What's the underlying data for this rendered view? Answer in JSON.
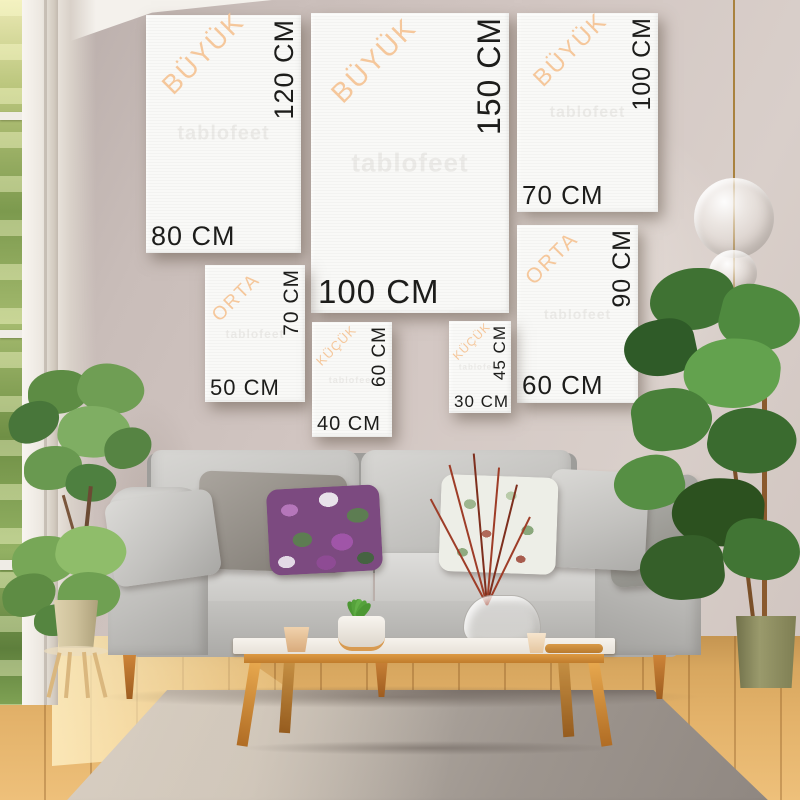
{
  "watermark_text": "tablofeet",
  "size_guide": {
    "unit": "CM",
    "size_names": {
      "large": "BÜYÜK",
      "medium": "ORTA",
      "small": "KÜÇÜK"
    },
    "canvases": [
      {
        "category": "BÜYÜK",
        "width": "80 CM",
        "height": "120 CM"
      },
      {
        "category": "BÜYÜK",
        "width": "100 CM",
        "height": "150 CM"
      },
      {
        "category": "BÜYÜK",
        "width": "70 CM",
        "height": "100 CM"
      },
      {
        "category": "ORTA",
        "width": "60 CM",
        "height": "90 CM"
      },
      {
        "category": "ORTA",
        "width": "50 CM",
        "height": "70 CM"
      },
      {
        "category": "KÜÇÜK",
        "width": "40 CM",
        "height": "60 CM"
      },
      {
        "category": "KÜÇÜK",
        "width": "30 CM",
        "height": "45 CM"
      }
    ]
  },
  "colors": {
    "wall": "#cfc3bf",
    "canvas": "#f9f9f7",
    "category_text": "#f5c79b",
    "measurement_text": "#1d1d1b",
    "sofa": "#c7c6c3",
    "floor_wood": "#d8a75f",
    "rug": "#a49c95",
    "table_wood": "#dd9a42",
    "foliage": "#4f8a3f",
    "pendant_brass": "#a9823f"
  }
}
